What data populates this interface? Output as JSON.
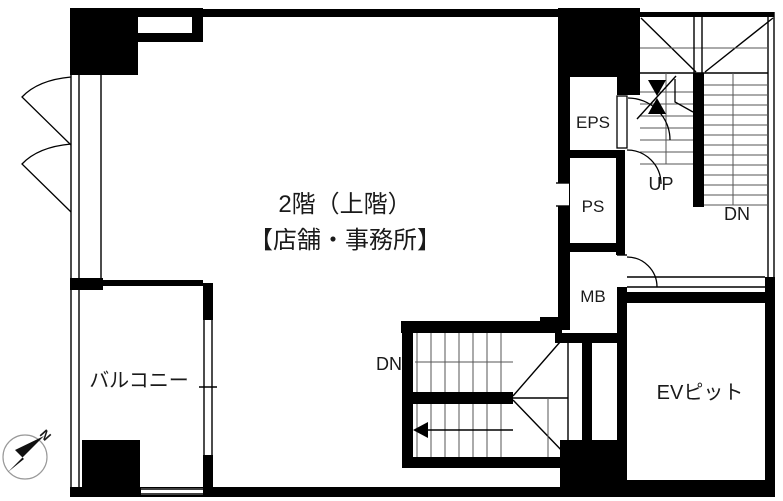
{
  "title": {
    "line1": "2階（上階）",
    "line2": "【店舗・事務所】"
  },
  "rooms": {
    "balcony": "バルコニー",
    "eps": "EPS",
    "ps": "PS",
    "mb": "MB",
    "ev_pit": "EVピット"
  },
  "stairs": {
    "up": "UP",
    "dn_upper": "DN",
    "dn_lower": "DN"
  },
  "compass": {
    "north": "N"
  },
  "colors": {
    "wall": "#000000",
    "tread_line": "#555555",
    "background": "#ffffff"
  }
}
